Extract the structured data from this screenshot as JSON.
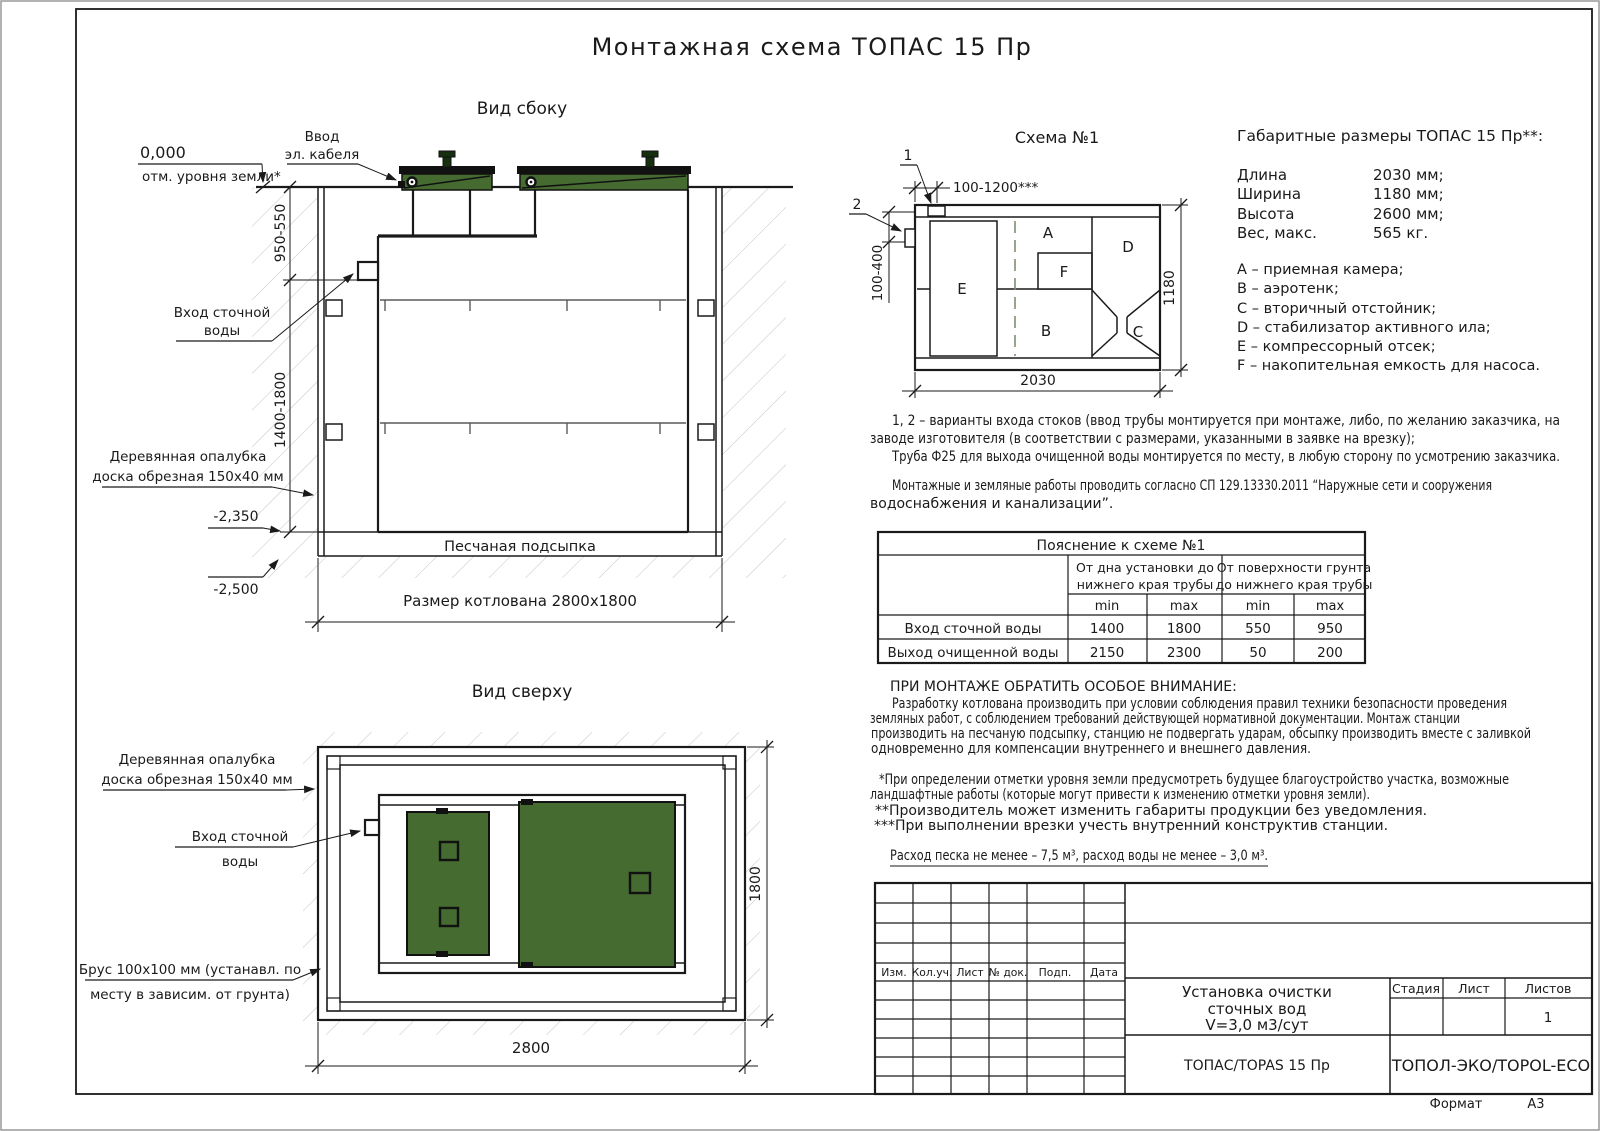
{
  "doc": {
    "title": "Монтажная схема ТОПАС 15 Пр",
    "format_label": "Формат",
    "format_value": "А3"
  },
  "side": {
    "title": "Вид сбоку",
    "zero": "0,000",
    "ground_note": "отм. уровня земли*",
    "cable1": "Ввод",
    "cable2": "эл. кабеля",
    "inlet1": "Вход сточной",
    "inlet2": "воды",
    "formwork1": "Деревянная опалубка",
    "formwork2": "доска обрезная 150х40 мм",
    "dim_upper": "950-550",
    "dim_lower": "1400-1800",
    "elev1": "-2,350",
    "elev2": "-2,500",
    "sand": "Песчаная подсыпка",
    "pit_size": "Размер котлована 2800х1800"
  },
  "top": {
    "title": "Вид сверху",
    "formwork1": "Деревянная опалубка",
    "formwork2": "доска обрезная 150х40 мм",
    "inlet1": "Вход сточной",
    "inlet2": "воды",
    "beam1": "Брус 100х100 мм (устанавл. по",
    "beam2": "месту в зависим. от грунта)",
    "dim_width": "1800",
    "dim_length": "2800"
  },
  "schema": {
    "title": "Схема №1",
    "marker1": "1",
    "marker2": "2",
    "dim_top": "100-1200***",
    "dim_left": "100-400",
    "dim_right": "1180",
    "dim_bottom": "2030",
    "comp_a": "A",
    "comp_b": "B",
    "comp_c": "C",
    "comp_d": "D",
    "comp_e": "E",
    "comp_f": "F"
  },
  "specs": {
    "title": "Габаритные размеры ТОПАС 15 Пр**:",
    "rows": [
      {
        "label": "Длина",
        "value": "2030 мм;"
      },
      {
        "label": "Ширина",
        "value": "1180 мм;"
      },
      {
        "label": "Высота",
        "value": "2600 мм;"
      },
      {
        "label": "Вес, макс.",
        "value": "565 кг."
      }
    ],
    "legend": [
      "А – приемная камера;",
      "В – аэротенк;",
      "С – вторичный отстойник;",
      "D – стабилизатор активного ила;",
      "Е – компрессорный отсек;",
      "F – накопительная емкость для насоса."
    ]
  },
  "notes": {
    "variants": [
      "1, 2 – варианты входа  стоков (ввод трубы монтируется при монтаже, либо, по желанию заказчика, на",
      "заводе изготовителя (в соответствии с размерами, указанными в заявке на врезку);",
      "Труба Ф25 для выхода очищенной воды монтируется по месту, в любую сторону по усмотрению заказчика."
    ],
    "works": [
      "Монтажные и земляные работы проводить согласно СП 129.13330.2011 “Наружные сети и сооружения",
      "водоснабжения и канализации”."
    ],
    "attention_title": "ПРИ МОНТАЖЕ ОБРАТИТЬ ОСОБОЕ ВНИМАНИЕ:",
    "attention": [
      "Разработку котлована производить при условии соблюдения правил техники безопасности проведения",
      "земляных работ, с соблюдением требований действующей нормативной документации. Монтаж станции",
      "производить на песчаную подсыпку, станцию не подвергать ударам, обсыпку производить вместе с заливкой",
      "одновременно для компенсации внутреннего и внешнего давления."
    ],
    "footnotes": [
      "*При определении отметки уровня земли предусмотреть будущее благоустройство участка, возможные",
      "ландшафтные работы (которые могут привести к изменению отметки уровня земли).",
      "**Производитель может изменить габариты продукции без уведомления.",
      "***При выполнении врезки учесть внутренний конструктив станции."
    ],
    "consumption": "Расход песка не менее – 7,5 м³, расход воды не менее – 3,0 м³."
  },
  "table": {
    "title": "Пояснение к схеме №1",
    "group1_line1": "От дна установки до",
    "group1_line2": "нижнего края трубы",
    "group2_line1": "От поверхности грунта",
    "group2_line2": "до нижнего края трубы",
    "min": "min",
    "max": "max",
    "rows": [
      {
        "label": "Вход сточной воды",
        "v1": "1400",
        "v2": "1800",
        "v3": "550",
        "v4": "950"
      },
      {
        "label": "Выход очищенной воды",
        "v1": "2150",
        "v2": "2300",
        "v3": "50",
        "v4": "200"
      }
    ]
  },
  "title_block": {
    "columns": [
      "Изм.",
      "Кол.уч.",
      "Лист",
      "№ док.",
      "Подп.",
      "Дата"
    ],
    "doc_title1": "Установка очистки",
    "doc_title2": "сточных вод",
    "doc_title3": "V=3,0 м3/сут",
    "stage_label": "Стадия",
    "sheet_label": "Лист",
    "sheets_label": "Листов",
    "sheets_value": "1",
    "product": "ТОПАС/TOPAS 15 Пр",
    "company": "ТОПОЛ-ЭКО/TOPOL-ECO"
  },
  "colors": {
    "lid_green": "#456b30",
    "vent_dark": "#16300f",
    "line": "#1c1c1c",
    "hatch": "#c9c9c9",
    "dashed": "#7e8f6e"
  }
}
